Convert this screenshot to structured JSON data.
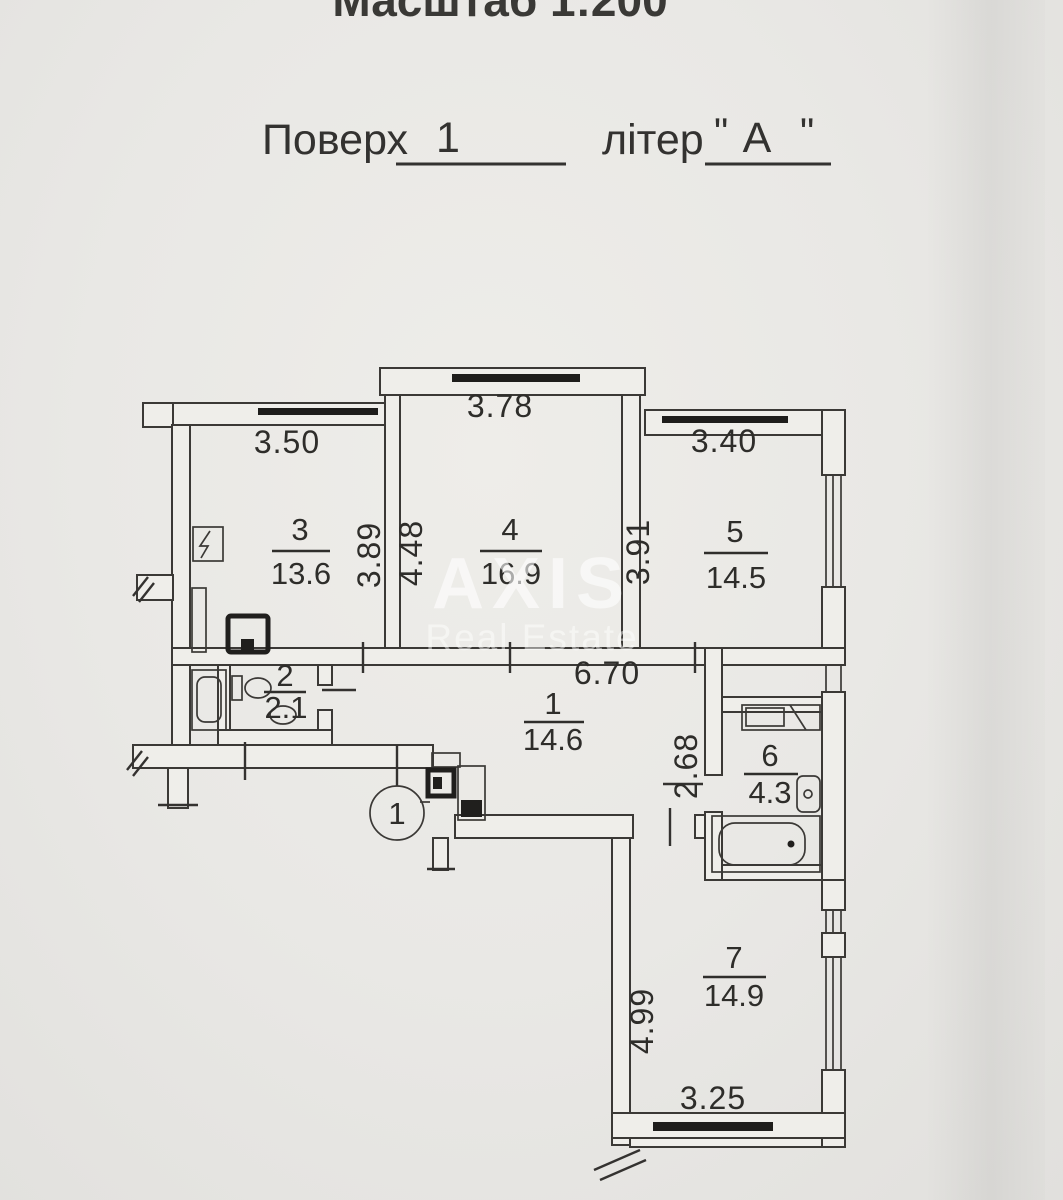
{
  "header": {
    "scale_text": "Масштаб 1:200",
    "floor_label": "Поверх",
    "floor_value": "1",
    "letter_label": "літер",
    "open_quote": "\"",
    "letter_value": "А",
    "close_quote": "\""
  },
  "watermark": {
    "line1": "AXIS",
    "line2": "Real Estate"
  },
  "axis_marker": {
    "label": "1"
  },
  "rooms": [
    {
      "number": "1",
      "area": "14.6"
    },
    {
      "number": "2",
      "area": "2.1"
    },
    {
      "number": "3",
      "area": "13.6"
    },
    {
      "number": "4",
      "area": "16.9"
    },
    {
      "number": "5",
      "area": "14.5"
    },
    {
      "number": "6",
      "area": "4.3"
    },
    {
      "number": "7",
      "area": "14.9"
    }
  ],
  "dimensions": {
    "room3_width": "3.50",
    "room4_width": "3.78",
    "room5_width": "3.40",
    "room3_depth": "3.89",
    "room4_depth": "4.48",
    "room5_depth": "3.91",
    "hall_width": "6.70",
    "room6_depth": "2.68",
    "room7_depth": "4.99",
    "room7_width": "3.25"
  },
  "colors": {
    "paper": "#e9e8e5",
    "ink": "#3a3835",
    "watermark": "#ffffff"
  }
}
